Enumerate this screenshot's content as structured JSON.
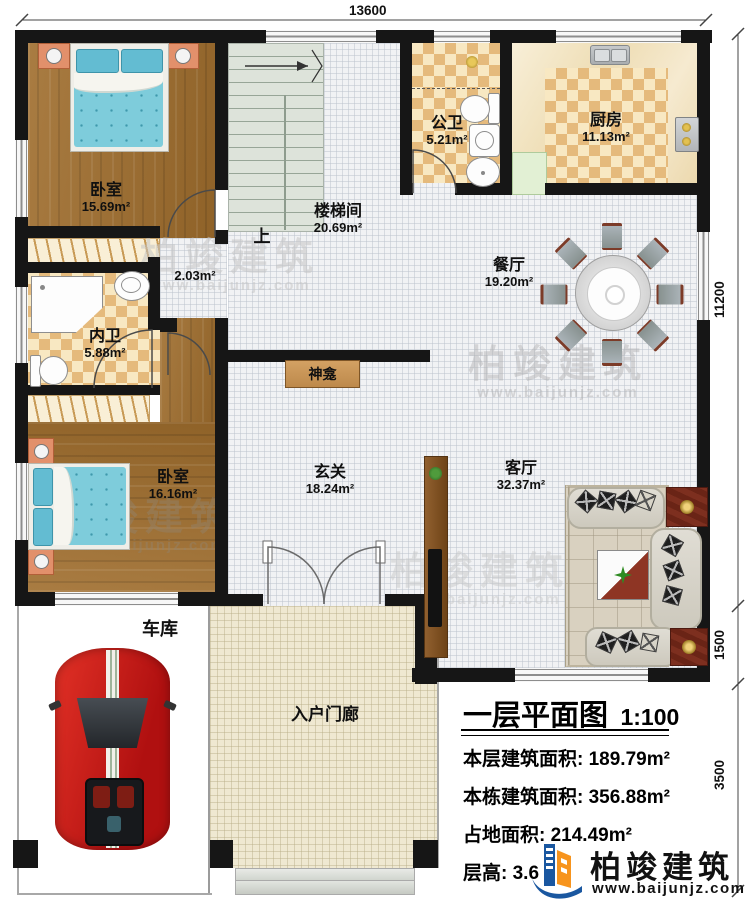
{
  "dimensions": {
    "width_top": "13600",
    "height_main": "11200",
    "height_mid": "1500",
    "height_porch": "3500"
  },
  "rooms": {
    "bedroom1": {
      "name": "卧室",
      "area": "15.69m²"
    },
    "stairwell": {
      "name": "楼梯间",
      "area": "20.69m²"
    },
    "corridor": {
      "area": "2.03m²"
    },
    "public_bath": {
      "name": "公卫",
      "area": "5.21m²"
    },
    "kitchen": {
      "name": "厨房",
      "area": "11.13m²"
    },
    "dining": {
      "name": "餐厅",
      "area": "19.20m²"
    },
    "master_bath": {
      "name": "内卫",
      "area": "5.88m²"
    },
    "bedroom2": {
      "name": "卧室",
      "area": "16.16m²"
    },
    "foyer": {
      "name": "玄关",
      "area": "18.24m²"
    },
    "living": {
      "name": "客厅",
      "area": "32.37m²"
    },
    "garage": {
      "name": "车库"
    },
    "porch": {
      "name": "入户门廊"
    }
  },
  "annotations": {
    "stairs_up": "上",
    "shrine": "神龛"
  },
  "title_block": {
    "title": "一层平面图",
    "scale": "1:100",
    "floor_area_label": "本层建筑面积:",
    "floor_area_value": "189.79m²",
    "building_area_label": "本栋建筑面积:",
    "building_area_value": "356.88m²",
    "footprint_label": "占地面积:",
    "footprint_value": "214.49m²",
    "height_label": "层高:",
    "height_value": "3.6"
  },
  "brand": {
    "name": "柏竣建筑",
    "website": "www.baijunjz.com"
  },
  "colors": {
    "wall": "#161616",
    "wood": "#a0743e",
    "accent_blue": "#1a57a0",
    "accent_orange": "#f7941d"
  }
}
